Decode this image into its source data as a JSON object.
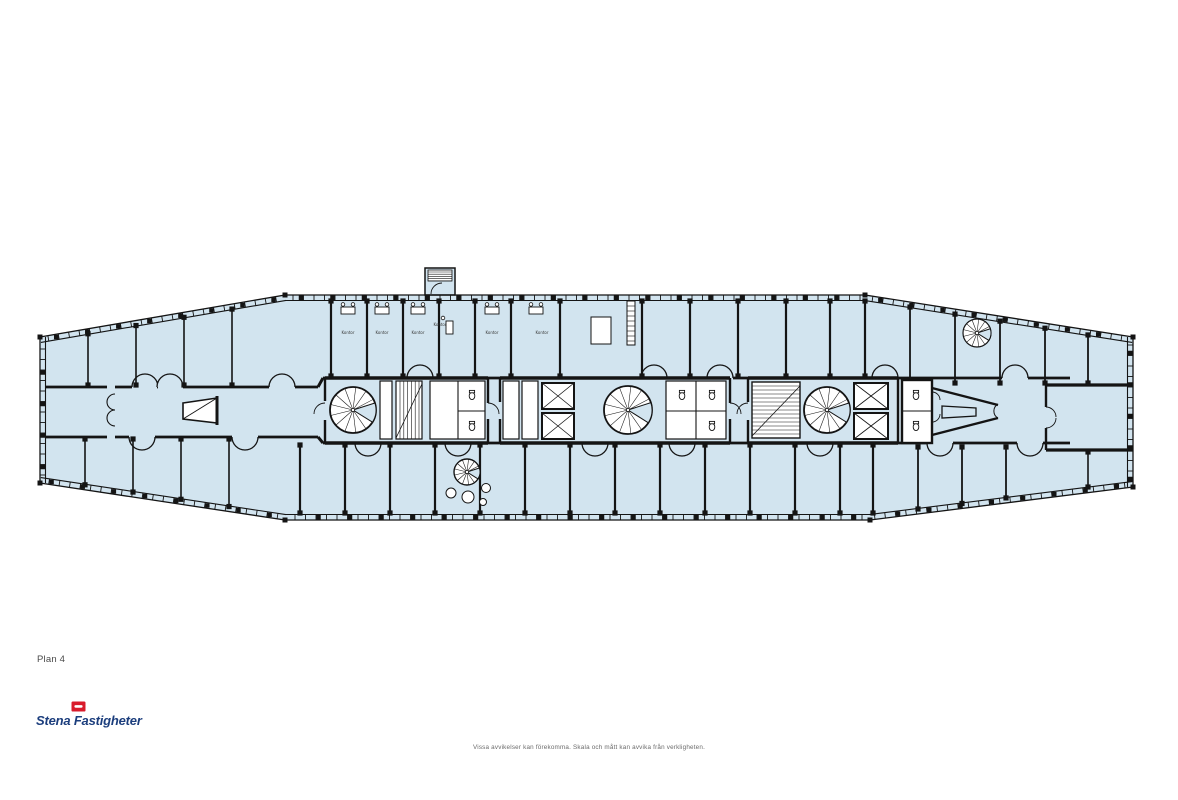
{
  "plan": {
    "label": "Plan 4",
    "room_labels": [
      "Kontor",
      "Kontor",
      "Kontor",
      "Kontor",
      "Kontor",
      "Kontor"
    ],
    "colors": {
      "floor_fill": "#d2e4ef",
      "wall": "#141414",
      "detail_white": "#ffffff"
    }
  },
  "footer": {
    "logo_text": "Stena Fastigheter",
    "logo_colors": {
      "red": "#d91b2b",
      "blue": "#1c3e7d"
    },
    "disclaimer": "Vissa avvikelser kan förekomma. Skala och mått kan avvika från verkligheten."
  }
}
